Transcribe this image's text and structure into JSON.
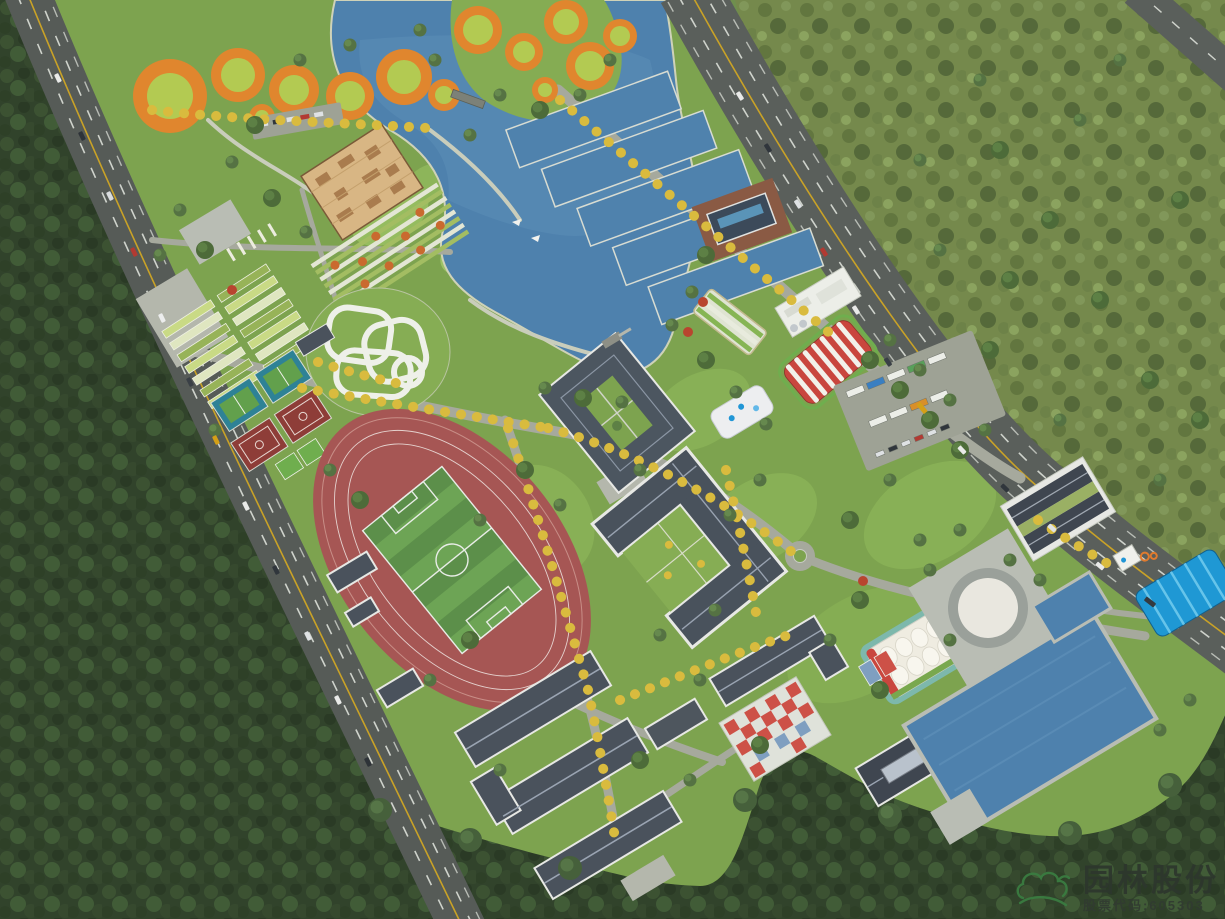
{
  "scene": {
    "name": "campus-park-aerial-render",
    "description": "Bird's-eye rendering of a landscaped sports-park campus bounded by tree-lined roads and forest",
    "features": [
      "lake",
      "river-channel",
      "orange-ring-gardens",
      "timber-maze",
      "garden-beds",
      "allotment-gardens",
      "pump-track",
      "tennis-courts",
      "basketball-courts",
      "running-track",
      "soccer-field",
      "courtyard-building",
      "u-shaped-main-building",
      "dormitory-rows",
      "water-treatment-pools",
      "pool-pavilion",
      "membrane-hall",
      "white-dome-tent",
      "slide-hill",
      "parking-lot-buses",
      "roundabout",
      "circular-plaza",
      "chinese-courtyard-building",
      "reservoir-pond",
      "blue-canopy",
      "kiosk",
      "checkered-courts",
      "city-road",
      "highway",
      "corner-road",
      "forest",
      "meadow",
      "stone-bridge",
      "pier",
      "kites"
    ]
  },
  "watermark": {
    "company": "园林股份",
    "stock_code": "股票代码:605303",
    "logo": "cloud-leaf-logo"
  },
  "palette": {
    "water": "#4e81ad",
    "lawn": "#7da34f",
    "forest_dark": "#31432b",
    "meadow_olive": "#75894c",
    "track_red": "#a65654",
    "field_green_dark": "#5c8f4a",
    "field_green_light": "#6da455",
    "ring_orange": "#e0862e",
    "ring_center_green": "#b3ca52",
    "tree_yellow": "#d9bb3e",
    "road_gray": "#585d59",
    "path_gray": "#a6a99d",
    "roof_slate": "#49525c",
    "wall_white": "#e7e8e4",
    "maze_tan": "#d8b684",
    "canopy_blue": "#1f98d4",
    "tent_red": "#c9463e",
    "logo_green": "#3a7d41"
  }
}
